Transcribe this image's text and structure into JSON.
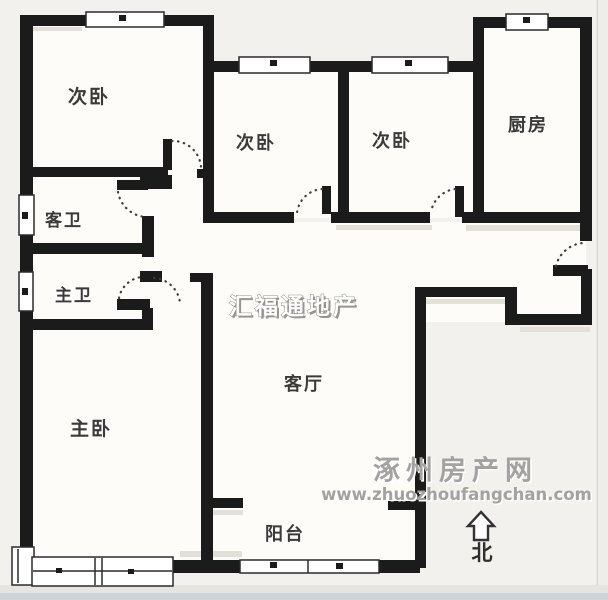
{
  "floorplan": {
    "rooms": [
      {
        "name": "bedroom-secondary-left",
        "label": "次卧"
      },
      {
        "name": "bedroom-secondary-middle",
        "label": "次卧"
      },
      {
        "name": "bedroom-secondary-right",
        "label": "次卧"
      },
      {
        "name": "kitchen",
        "label": "厨房"
      },
      {
        "name": "guest-bathroom",
        "label": "客卫"
      },
      {
        "name": "master-bathroom",
        "label": "主卫"
      },
      {
        "name": "master-bedroom",
        "label": "主卧"
      },
      {
        "name": "living-room",
        "label": "客厅"
      },
      {
        "name": "balcony",
        "label": "阳台"
      }
    ],
    "compass": {
      "label": "北"
    },
    "watermarks": {
      "agency": "汇福通地产",
      "site": "涿州房产网",
      "url": "www.zhuozhoufangchan.com"
    },
    "colors": {
      "wall": "#1b1b1b",
      "background": "#f3f1ed",
      "room_fill": "#fdfcf9",
      "watermark_gray": "#a3a2a0",
      "label_text": "#3a3a3a"
    }
  }
}
